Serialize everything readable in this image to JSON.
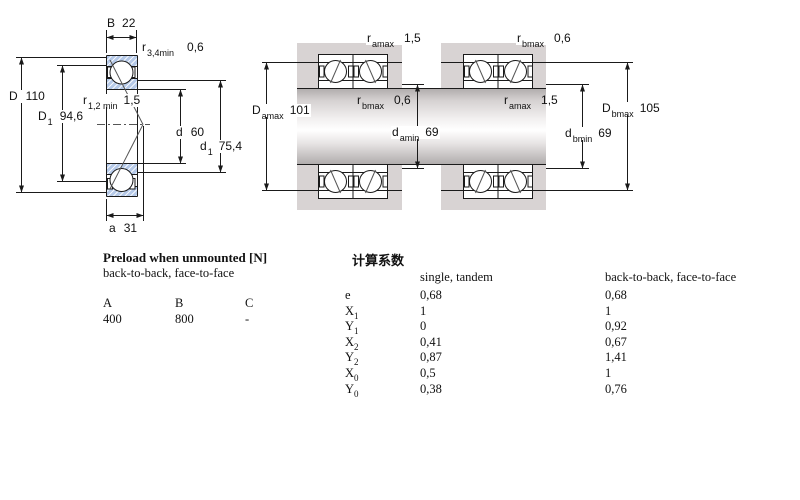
{
  "diagram": {
    "left": {
      "B": {
        "sym": "B",
        "sub": "",
        "val": "22"
      },
      "r34": {
        "sym": "r",
        "sub": "3,4min",
        "val": "0,6"
      },
      "D": {
        "sym": "D",
        "sub": "",
        "val": "110"
      },
      "D1": {
        "sym": "D",
        "sub": "1",
        "val": "94,6"
      },
      "r12": {
        "sym": "r",
        "sub": "1,2 min",
        "val": "1,5"
      },
      "d": {
        "sym": "d",
        "sub": "",
        "val": "60"
      },
      "d1": {
        "sym": "d",
        "sub": "1",
        "val": "75,4"
      },
      "a": {
        "sym": "a",
        "sub": "",
        "val": "31"
      }
    },
    "middle_a": {
      "ramax": {
        "sym": "r",
        "sub": "amax",
        "val": "1,5"
      },
      "rbmax": {
        "sym": "r",
        "sub": "bmax",
        "val": "0,6"
      },
      "Damax": {
        "sym": "D",
        "sub": "amax",
        "val": "101"
      },
      "damin": {
        "sym": "d",
        "sub": "amin",
        "val": "69"
      }
    },
    "middle_b": {
      "rbmax": {
        "sym": "r",
        "sub": "bmax",
        "val": "0,6"
      },
      "ramax": {
        "sym": "r",
        "sub": "amax",
        "val": "1,5"
      },
      "Dbmax": {
        "sym": "D",
        "sub": "bmax",
        "val": "105"
      },
      "dbmin": {
        "sym": "d",
        "sub": "bmin",
        "val": "69"
      }
    }
  },
  "preload": {
    "title": "Preload when unmounted [N]",
    "subtitle": "back-to-back, face-to-face",
    "columns": [
      "A",
      "B",
      "C"
    ],
    "values": [
      "400",
      "800",
      "-"
    ]
  },
  "factors": {
    "title": "计算系数",
    "col1": "single, tandem",
    "col2": "back-to-back, face-to-face",
    "rows": [
      {
        "sym": "e",
        "sub": "",
        "v1": "0,68",
        "v2": "0,68"
      },
      {
        "sym": "X",
        "sub": "1",
        "v1": "1",
        "v2": "1"
      },
      {
        "sym": "Y",
        "sub": "1",
        "v1": "0",
        "v2": "0,92"
      },
      {
        "sym": "X",
        "sub": "2",
        "v1": "0,41",
        "v2": "0,67"
      },
      {
        "sym": "Y",
        "sub": "2",
        "v1": "0,87",
        "v2": "1,41"
      },
      {
        "sym": "X",
        "sub": "0",
        "v1": "0,5",
        "v2": "1"
      },
      {
        "sym": "Y",
        "sub": "0",
        "v1": "0,38",
        "v2": "0,76"
      }
    ]
  },
  "colors": {
    "ring_blue": "#b5c9e8",
    "housing_gray": "#d8d3d3",
    "line": "#1a1a1a"
  }
}
